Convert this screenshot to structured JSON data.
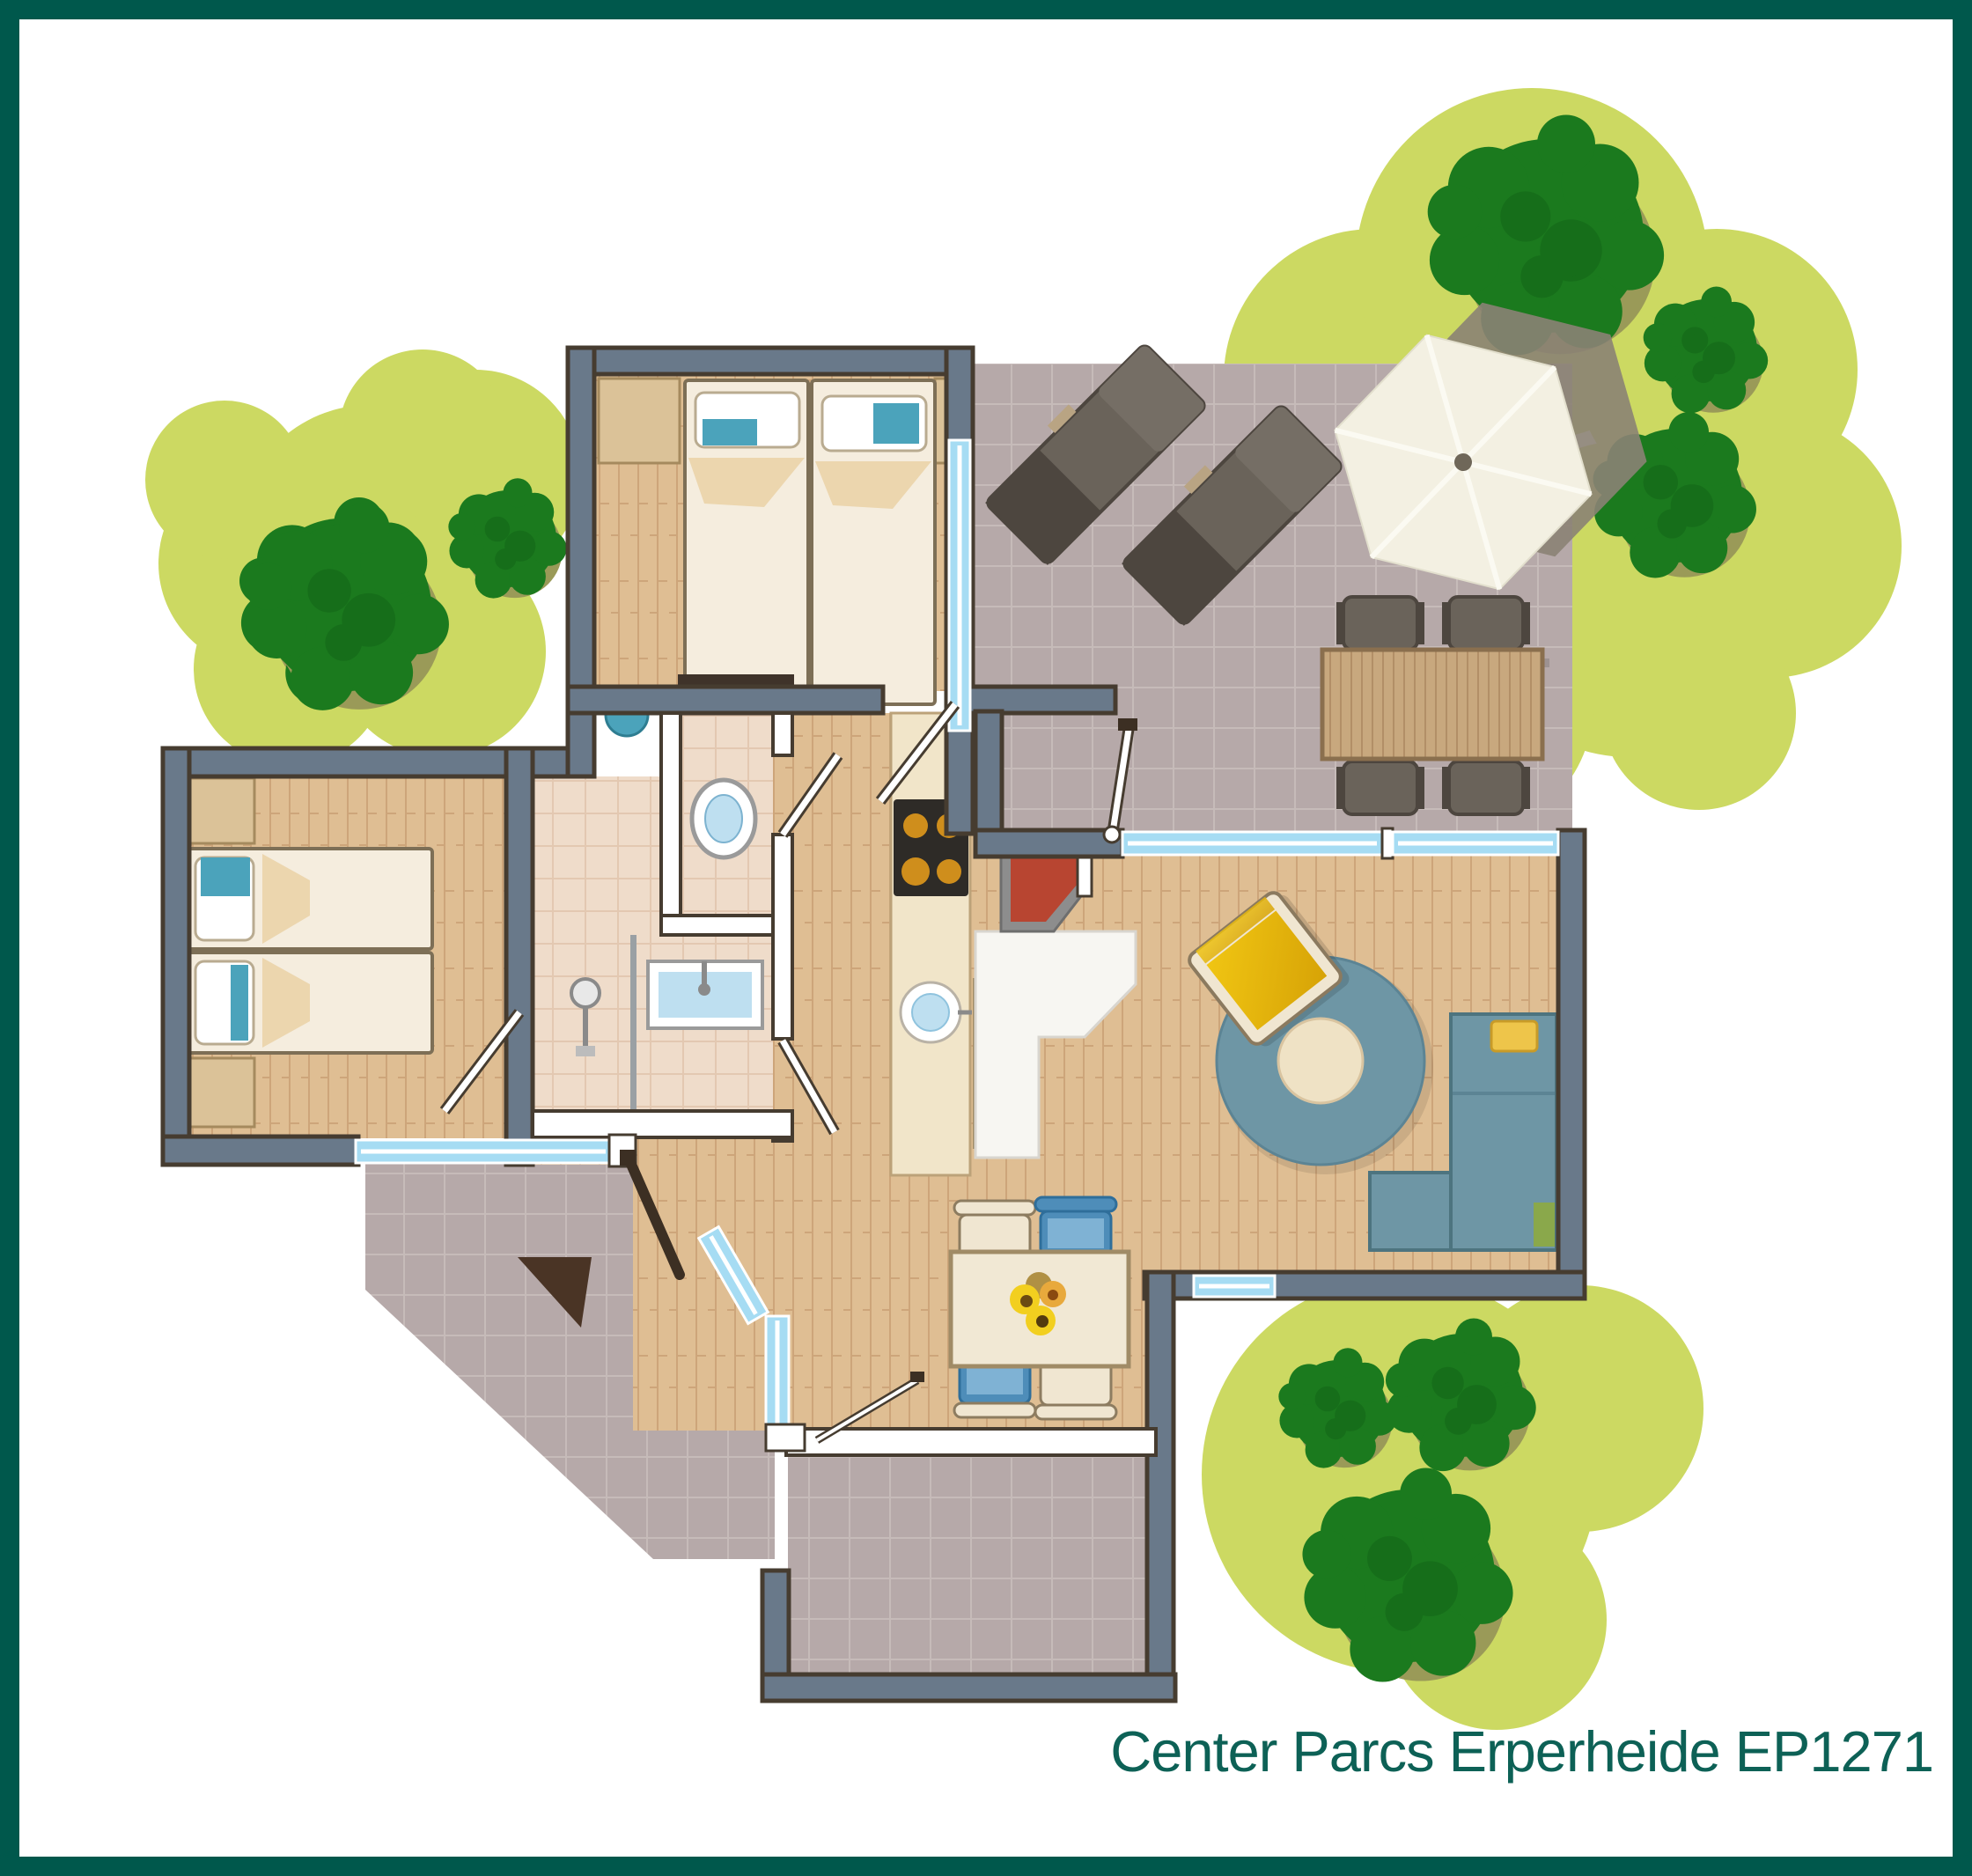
{
  "title": {
    "text": "Center Parcs Erperheide EP1271"
  },
  "colors": {
    "frame": "#00584c",
    "caption": "#0d6156",
    "grass": "#ccd962",
    "tree": "#1b7a1e",
    "treeDark": "#0f5a14",
    "treeShadow": "#9a9a58",
    "tile": "#b6a9a9",
    "tileLine": "#c6bbb9",
    "wood": "#dfbe93",
    "woodLine": "#cda57a",
    "bathTile": "#efdcca",
    "bathLine": "#e3c8b1",
    "wall": "#69798a",
    "wallEdge": "#463c30",
    "windowGlass": "#a6dcf3",
    "counter": "#f1e5c9",
    "counterEdge": "#bca279",
    "stove": "#2e2b27",
    "burner": "#cf8e1c",
    "sofa": "#6e96a5",
    "sofaEdge": "#4d747f",
    "rugCenter": "#efe2c5",
    "armYellow": "#f0c513",
    "armYellowDark": "#d7a306",
    "chairCream": "#f0e6d1",
    "chairBlue": "#4e8db9",
    "bedSheet": "#f5edde",
    "bedEdge": "#7d6f56",
    "bedFold": "#ecd6ae",
    "accent": "#4ba3bb",
    "headboard": "#dbc298",
    "fire": "#b84531",
    "fireFrame": "#8d8d8d",
    "hearth": "#f7f6f2",
    "outdoor": "#6a635a",
    "outdoorDark": "#4d463f",
    "slatWood": "#c8a87e",
    "slatLine": "#b28f67",
    "umbrella": "#f3f0e2",
    "umbrellaShadow": "#8b8274",
    "leafDark": "#3c2f23",
    "doormat": "#4a3425",
    "dresser": "#3f332a",
    "sinkBlue": "#bedff0"
  }
}
